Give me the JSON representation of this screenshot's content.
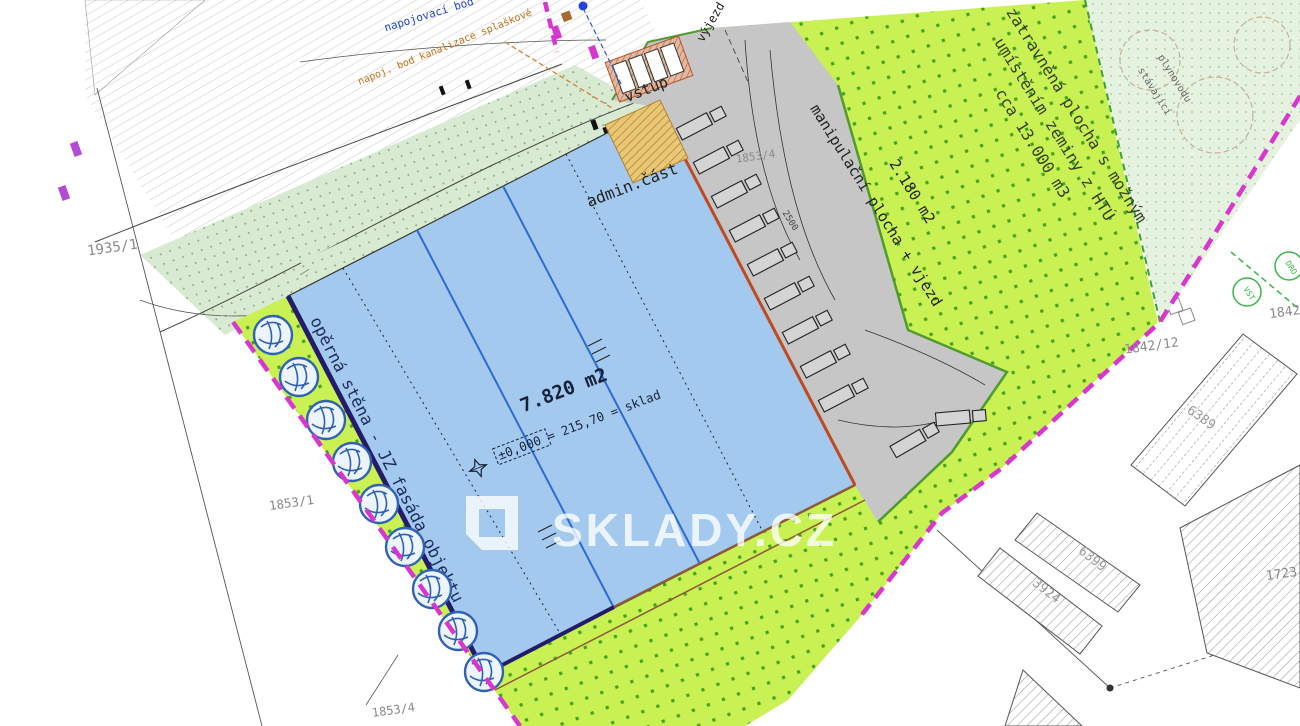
{
  "watermark": {
    "brand": "SKLADY.CZ"
  },
  "building": {
    "area": "7.820 m2",
    "level": "±0,000 = 215,70 = sklad",
    "admin": "admin.část",
    "wall": "opěrná stěna - JZ fasáda objektu"
  },
  "access": {
    "entry": "vstup",
    "exit": "výjezd"
  },
  "yard": {
    "label": "manipulační plocha + vjezd",
    "area": "2.180 m2",
    "dim": "2500",
    "parcel": "1853/4"
  },
  "green": {
    "line1": "zatravněná plocha s možným",
    "line2": "umístěním zeminy z HTÚ",
    "line3": "cca 13.000 m3"
  },
  "vegetation": {
    "label1": "plynovodu",
    "label2": "stávající"
  },
  "utilities": {
    "water": "napojovací bod",
    "sewer": "napoj. bod kanalizace splaškové"
  },
  "parcels": {
    "p1": "1935/1",
    "p2": "1853/1",
    "p3": "1842/12",
    "p4": "1842/1",
    "p5": "6389",
    "p6": "6399",
    "p7": "3924",
    "p8": "1723",
    "p9": "1853/4"
  },
  "stamps": {
    "s1": "VST",
    "s2": "DRO"
  },
  "colors": {
    "site_green": "#c9f153",
    "green_dot": "#44a31c",
    "building_fill": "#a4c9ef",
    "building_line": "#2b6bd5",
    "yard_gray": "#c6c6c6",
    "dock_red": "#bf4a1f",
    "wall_navy": "#241c6b",
    "boundary_magenta": "#d935cf",
    "admin_tan": "#e9c873",
    "watermark_white": "rgba(255,255,255,0.78)"
  }
}
